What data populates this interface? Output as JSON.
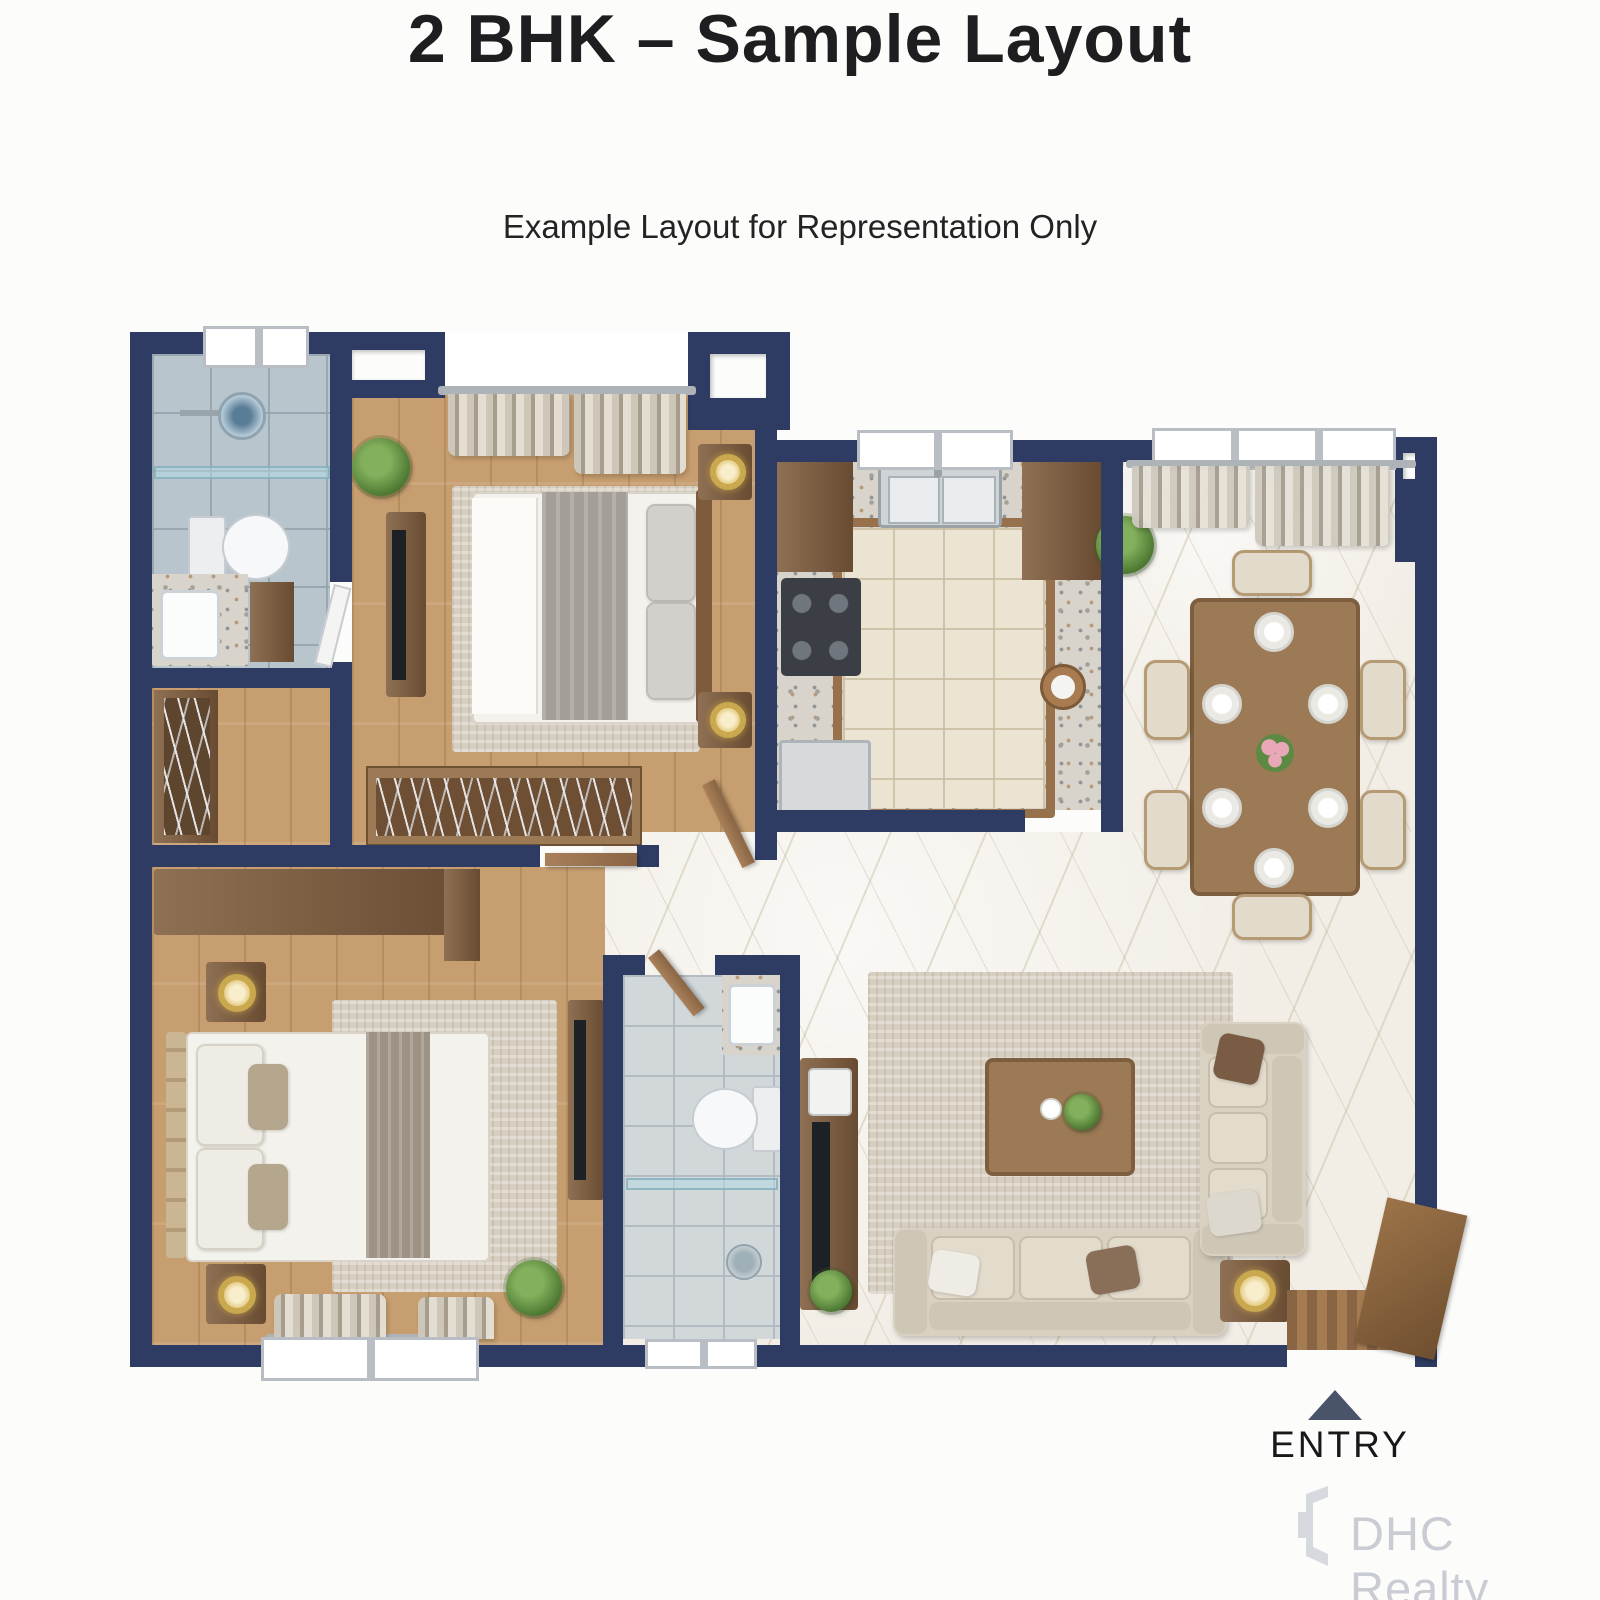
{
  "header": {
    "title": "2 BHK – Sample Layout",
    "subtitle": "Example Layout for Representation Only"
  },
  "entry": {
    "label": "ENTRY",
    "arrow_icon": "entry-up-triangle"
  },
  "watermark": {
    "brand": "DHC Realty",
    "logo_icon": "dhc-realty-logo"
  },
  "colors": {
    "wall": "#2e3c63",
    "background": "#fcfcfb",
    "title_text": "#1e1e20",
    "wood_floor": "#c79e6f",
    "marble_floor": "#f2eee6",
    "bath_tile": "#b9c5cc",
    "accent_gold": "#c9a84e",
    "entry_arrow": "#49536a",
    "watermark_gray": "#c9ccd2"
  },
  "icons": {
    "entry_arrow": "up-triangle",
    "watermark_logo": "open-door-mark"
  }
}
